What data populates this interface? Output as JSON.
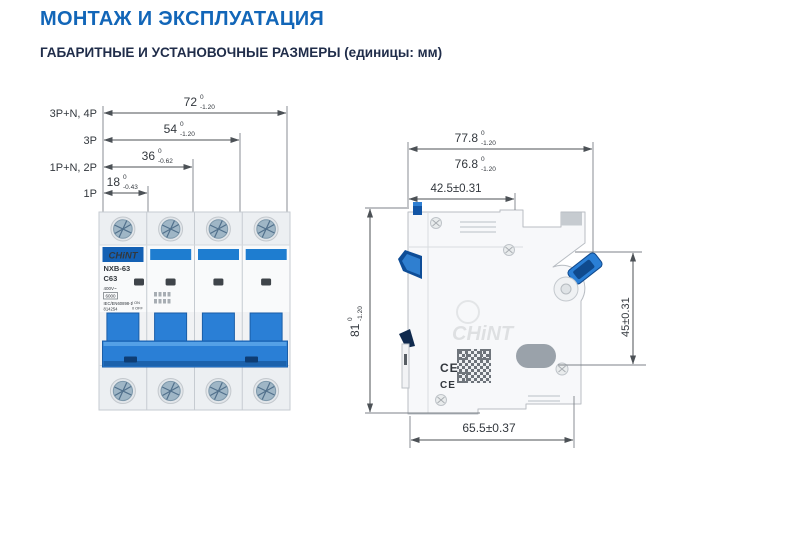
{
  "header": {
    "title": "МОНТАЖ И ЭКСПЛУАТАЦИЯ",
    "subtitle": "ГАБАРИТНЫЕ И УСТАНОВОЧНЫЕ РАЗМЕРЫ (единицы: мм)"
  },
  "front_view": {
    "rows": [
      {
        "label": "3P+N, 4P",
        "value": "72",
        "tol_upper": "0",
        "tol_lower": "-1.20"
      },
      {
        "label": "3P",
        "value": "54",
        "tol_upper": "0",
        "tol_lower": "-1.20"
      },
      {
        "label": "1P+N, 2P",
        "value": "36",
        "tol_upper": "0",
        "tol_lower": "-0.62"
      },
      {
        "label": "1P",
        "value": "18",
        "tol_upper": "0",
        "tol_lower": "-0.43"
      }
    ],
    "breaker": {
      "brand": "CHiNT",
      "model": "NXB-63",
      "rating": "C63",
      "voltage": "400V~",
      "breaking_capacity": "6000",
      "standard": "IEC/EN60898-1",
      "article": "814254",
      "on_mark": "I  ON",
      "off_mark": "0  OFF"
    }
  },
  "side_view": {
    "width_full": {
      "value": "77.8",
      "tol_upper": "0",
      "tol_lower": "-1.20"
    },
    "width_inner": {
      "value": "76.8",
      "tol_upper": "0",
      "tol_lower": "-1.20"
    },
    "top_depth": "42.5±0.31",
    "height": {
      "value": "81",
      "tol_upper": "0",
      "tol_lower": "-1.20"
    },
    "rail_height": "45±0.31",
    "base_depth": "65.5±0.37",
    "ce_mark": "CE"
  },
  "colors": {
    "accent_blue": "#1266b8",
    "dark_navy": "#202d4a",
    "breaker_blue": "#2a7fd6",
    "brand_band_blue": "#1360b4"
  }
}
